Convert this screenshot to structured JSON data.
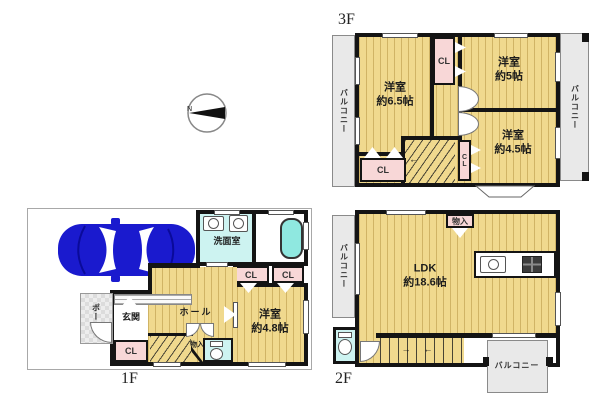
{
  "compass": {
    "north": "N"
  },
  "f3": {
    "label": "3F",
    "balcony_left": "バルコニー",
    "balcony_right": "バルコニー",
    "room_west_name": "洋室",
    "room_west_size": "約6.5帖",
    "room_ne_name": "洋室",
    "room_ne_size": "約5帖",
    "room_se_name": "洋室",
    "room_se_size": "約4.5帖",
    "closet_top": "CL",
    "closet_stair": "CL",
    "closet_bottom": "CL",
    "stair_arrow": "←"
  },
  "f2": {
    "label": "2F",
    "balcony_left": "バルコニー",
    "balcony_bottom": "バルコニー",
    "ldk_name": "LDK",
    "ldk_size": "約18.6帖",
    "storage": "物入",
    "stair_arrow_right": "→",
    "stair_arrow_left": "←"
  },
  "f1": {
    "label": "1F",
    "washroom": "洗面室",
    "entrance": "玄関",
    "porch": "ポーチ",
    "hall": "ホール",
    "closet_a": "CL",
    "closet_b": "CL",
    "closet_entrance": "CL",
    "storage": "物入",
    "bedroom_name": "洋室",
    "bedroom_size": "約4.8帖"
  },
  "colors": {
    "floor": "#f0d98e",
    "closet_pink": "#f8d7d7",
    "water_cyan": "#cdf3f1",
    "tub_cyan": "#8fe8e0",
    "balcony_gray": "#e9e9e9",
    "wall_black": "#141414",
    "car_blue": "#1a1ace"
  }
}
